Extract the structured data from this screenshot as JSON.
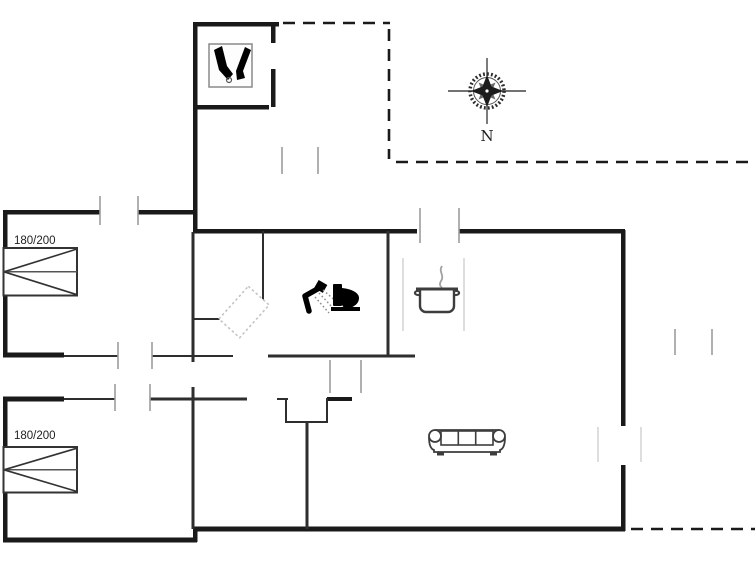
{
  "floor_plan": {
    "compass": {
      "north_label": "N"
    },
    "bedrooms": [
      {
        "name": "bedroom-1",
        "bed_size_label": "180/200"
      },
      {
        "name": "bedroom-2",
        "bed_size_label": "180/200"
      }
    ],
    "icons": [
      {
        "name": "utility-boots-icon"
      },
      {
        "name": "compass-rose-icon"
      },
      {
        "name": "shower-icon"
      },
      {
        "name": "toilet-icon"
      },
      {
        "name": "cooking-pot-icon"
      },
      {
        "name": "sofa-icon"
      },
      {
        "name": "double-bed-icon"
      },
      {
        "name": "double-bed-icon"
      }
    ],
    "colors": {
      "background": "#ffffff",
      "wall": "#1a1a1a",
      "thinwall": "#2e2e2e",
      "furniture": "#3d3d3d",
      "tick": "#9c9c9c",
      "lighttick": "#cfcfcf",
      "icon_black": "#000000",
      "text": "#1f1f1f"
    }
  }
}
